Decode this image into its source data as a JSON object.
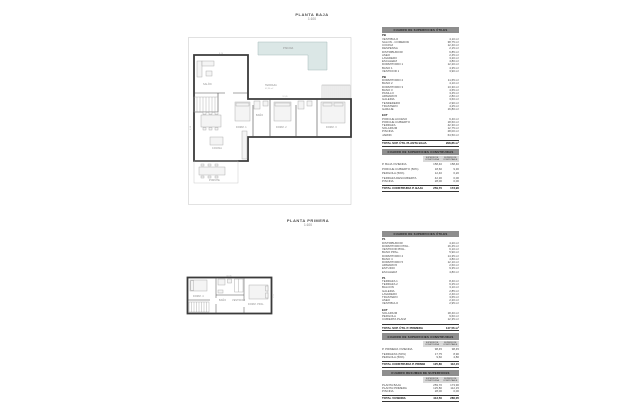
{
  "colors": {
    "pool_fill": "#dbe7e6",
    "pool_stroke": "#a7bcba",
    "wall": "#3b3b3b",
    "light_line": "#c4c4c4",
    "table_header_bg": "#8e8e8e"
  },
  "plans": {
    "baja": {
      "title": "PLANTA BAJA",
      "scale": "1:100",
      "labels": {
        "piscina": "PISCINA",
        "terraza": "TERRAZA",
        "terraza_area": "42,30 m²",
        "salon": "SALÓN",
        "cocina": "COCINA",
        "porche": "PORCHE",
        "dorm1": "DORM. 1",
        "dorm2": "DORM. 2",
        "dorm3": "DORM. 3",
        "bano": "BAÑO"
      },
      "dims": [
        "12,45",
        "8,20",
        "3,50"
      ]
    },
    "primera": {
      "title": "PLANTA PRIMERA",
      "scale": "1:100",
      "labels": {
        "dorm_ppal": "DORM. PPAL.",
        "dorm4": "DORM. 4",
        "bano": "BAÑO",
        "vestidor": "VESTIDOR"
      },
      "dims": [
        "10,35",
        "4,60"
      ]
    }
  },
  "area_tables": {
    "planta_baja": {
      "utiles": {
        "title": "CUADRO DE SUPERFICIES ÚTILES",
        "unit": "m²",
        "groups": [
          {
            "name": "PB",
            "rows": [
              [
                "VESTÍBULO",
                "4,10"
              ],
              [
                "SALÓN - COMEDOR",
                "38,75"
              ],
              [
                "COCINA",
                "12,40"
              ],
              [
                "DESPENSA",
                "2,15"
              ],
              [
                "DISTRIBUIDOR",
                "6,85"
              ],
              [
                "ASEO",
                "2,45"
              ],
              [
                "LAVADERO",
                "3,20"
              ],
              [
                "ESCALERA",
                "4,80"
              ],
              [
                "DORMITORIO 1",
                "12,20"
              ],
              [
                "BAÑO 1",
                "4,35"
              ],
              [
                "VESTIDOR 1",
                "3,90"
              ]
            ]
          },
          {
            "name": "PB",
            "rows": [
              [
                "DORMITORIO 2",
                "11,65"
              ],
              [
                "BAÑO 2",
                "4,10"
              ],
              [
                "DORMITORIO 3",
                "13,30"
              ],
              [
                "BAÑO 3",
                "4,65"
              ],
              [
                "PASILLO",
                "3,45"
              ],
              [
                "ARMARIOS",
                "2,80"
              ],
              [
                "GALERÍA",
                "3,60"
              ],
              [
                "TENDEDERO",
                "2,90"
              ],
              [
                "TRASTERO",
                "4,25"
              ],
              [
                "GARAJE",
                "16,80"
              ]
            ]
          },
          {
            "name": "EXT",
            "rows": [
              [
                "PORCHE ACCESO",
                "6,40"
              ],
              [
                "PORCHE CUBIERTO",
                "18,60"
              ],
              [
                "TERRAZA",
                "42,30"
              ],
              [
                "SOLÁRIUM",
                "12,75"
              ],
              [
                "PISCINA",
                "28,00"
              ],
              [
                "JARDÍN",
                "64,50"
              ]
            ]
          }
        ],
        "total": [
          "TOTAL SUP. ÚTIL PLANTA BAJA",
          "298,86 m²"
        ]
      },
      "construidas": {
        "title": "CUADRO DE SUPERFICIES CONSTRUIDAS",
        "columns": [
          "SUPERFICIE CONSTRUIDA",
          "SUPERFICIE COMPUTABLE"
        ],
        "rows": [
          [
            "P. BAJA VIVIENDA",
            "158,40",
            "158,40"
          ],
          null,
          [
            "PORCHE CUBIERTO (50%)",
            "18,60",
            "9,30"
          ],
          [
            "PÉRGOLA (50%)",
            "12,40",
            "6,20"
          ],
          null,
          [
            "TERRAZA DESCUBIERTA",
            "42,30",
            "0,00"
          ],
          [
            "PISCINA",
            "28,00",
            "0,00"
          ]
        ],
        "total": [
          "TOTAL CONSTRUIDA P. BAJA",
          "259,70",
          "173,90"
        ]
      }
    },
    "planta_primera": {
      "utiles": {
        "title": "CUADRO DE SUPERFICIES ÚTILES",
        "unit": "m²",
        "groups": [
          {
            "name": "P1",
            "rows": [
              [
                "DISTRIBUIDOR",
                "4,20"
              ],
              [
                "DORMITORIO PPAL.",
                "16,45"
              ],
              [
                "VESTIDOR PPAL.",
                "6,10"
              ],
              [
                "BAÑO PPAL.",
                "5,90"
              ],
              [
                "DORMITORIO 4",
                "14,35"
              ],
              [
                "BAÑO 4",
                "4,80"
              ],
              [
                "DORMITORIO 5",
                "12,10"
              ],
              [
                "ARMARIOS",
                "2,60"
              ],
              [
                "ESTUDIO",
                "9,35"
              ],
              [
                "ESCALERA",
                "4,80"
              ]
            ]
          },
          {
            "name": "P1",
            "rows": [
              [
                "TERRAZA 1",
                "8,40"
              ],
              [
                "TERRAZA 2",
                "6,25"
              ],
              [
                "BALCÓN",
                "3,10"
              ],
              [
                "GALERÍA",
                "2,85"
              ],
              [
                "LAVADERO",
                "2,40"
              ],
              [
                "TRASTERO",
                "3,65"
              ],
              [
                "ASEO",
                "2,20"
              ],
              [
                "VESTÍBULO",
                "2,95"
              ]
            ]
          },
          {
            "name": "EXT",
            "rows": [
              [
                "SOLÁRIUM",
                "18,40"
              ],
              [
                "PÉRGOLA",
                "9,60"
              ],
              [
                "CUBIERTA PLANA",
                "12,35"
              ]
            ]
          }
        ],
        "total": [
          "TOTAL SUP. ÚTIL P. PRIMERA",
          "147,56 m²"
        ]
      },
      "construidas": {
        "title": "CUADRO DE SUPERFICIES CONSTRUIDAS",
        "columns": [
          "SUPERFICIE CONSTRUIDA",
          "SUPERFICIE COMPUTABLE"
        ],
        "rows": [
          [
            "P. PRIMERA VIVIENDA",
            "98,45",
            "98,45"
          ],
          null,
          [
            "TERRAZAS (50%)",
            "17,75",
            "8,90"
          ],
          [
            "PÉRGOLA (50%)",
            "9,60",
            "4,80"
          ]
        ],
        "total": [
          "TOTAL CONSTRUIDA P. PRIMERA",
          "125,80",
          "112,15"
        ]
      },
      "resumen": {
        "title": "CUADRO RESUMEN DE SUPERFICIES",
        "columns": [
          "SUPERFICIE CONSTRUIDA",
          "SUPERFICIE COMPUTABLE"
        ],
        "rows": [
          [
            "PLANTA BAJA",
            "259,70",
            "173,90"
          ],
          [
            "PLANTA PRIMERA",
            "125,80",
            "112,15"
          ],
          [
            "PISCINA",
            "28,00",
            "0,00"
          ]
        ],
        "total": [
          "TOTAL VIVIENDA",
          "413,50",
          "286,05"
        ]
      }
    }
  }
}
